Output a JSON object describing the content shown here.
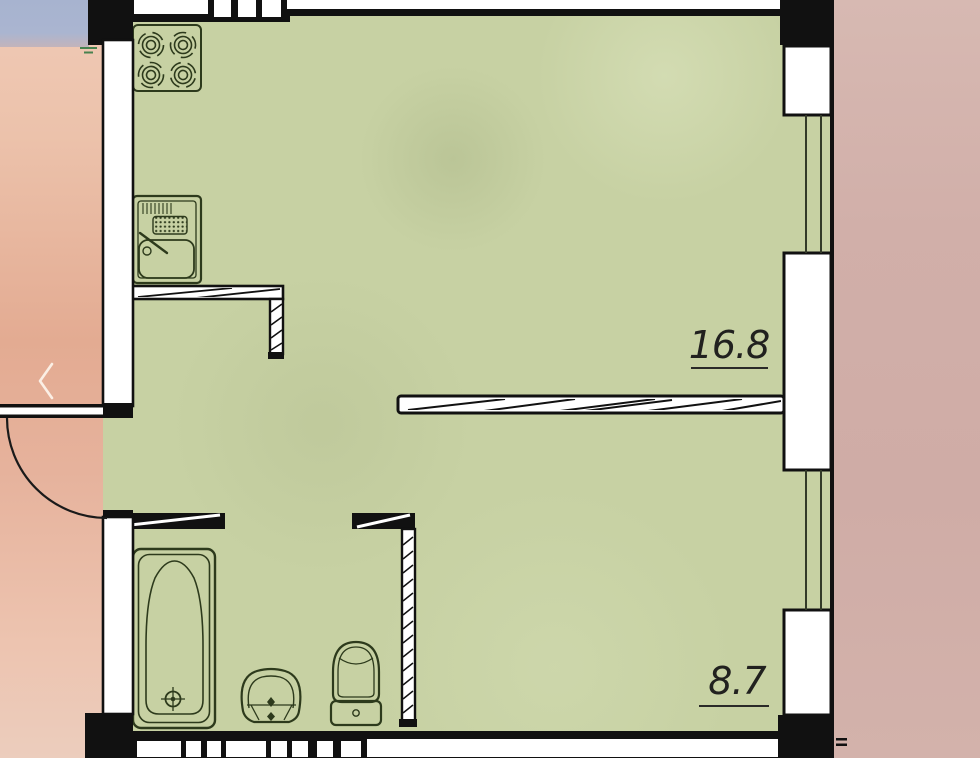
{
  "viewer": {
    "prev_button": {
      "icon": "chevron-left"
    }
  },
  "floorplan": {
    "room_labels": [
      {
        "area": "16.8"
      },
      {
        "area": "8.7"
      }
    ],
    "fixtures": [
      "stove-icon",
      "kitchen-sink-icon",
      "bathtub-icon",
      "washbasin-icon",
      "toilet-icon"
    ],
    "features": [
      "entry-door-swing",
      "interior-partition-walls",
      "exterior-windows"
    ],
    "colors": {
      "floor_green": "#c7d1a3",
      "wall_black": "#111111",
      "wall_white": "#ffffff",
      "fixture_line": "#2d3a1c",
      "label_text": "#21211f",
      "left_background_pink": "#e6b29c",
      "left_background_blue": "#aab5d0",
      "right_background_mauve": "#d2b1ab"
    }
  }
}
